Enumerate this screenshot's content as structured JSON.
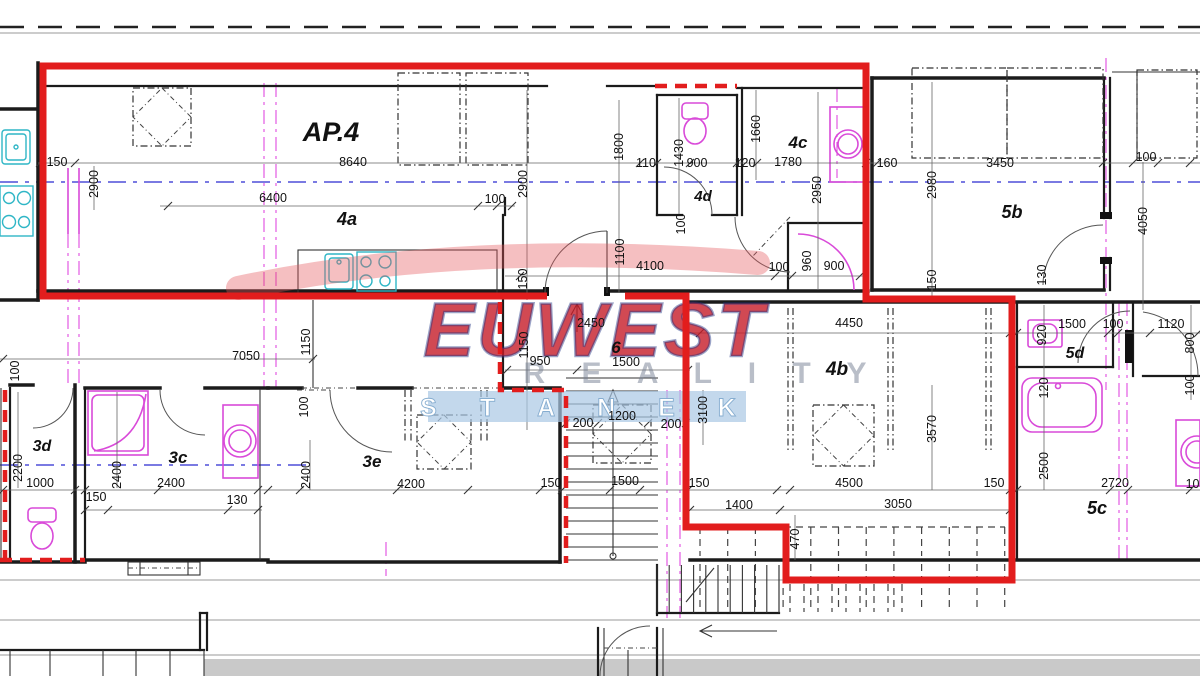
{
  "watermark": {
    "line1": "EUWEST",
    "line2": "R E A L I T Y",
    "line3": "S T A N E K"
  },
  "plan": {
    "apartment_label": "AP.4",
    "room_labels": [
      {
        "t": "AP.4",
        "x": 331,
        "y": 141,
        "s": 27
      },
      {
        "t": "4a",
        "x": 347,
        "y": 225,
        "s": 18
      },
      {
        "t": "4c",
        "x": 798,
        "y": 148,
        "s": 17
      },
      {
        "t": "4d",
        "x": 703,
        "y": 201,
        "s": 15
      },
      {
        "t": "5b",
        "x": 1012,
        "y": 218,
        "s": 18
      },
      {
        "t": "6",
        "x": 616,
        "y": 353,
        "s": 17
      },
      {
        "t": "4b",
        "x": 837,
        "y": 375,
        "s": 19
      },
      {
        "t": "5d",
        "x": 1075,
        "y": 358,
        "s": 16
      },
      {
        "t": "5c",
        "x": 1097,
        "y": 514,
        "s": 18
      },
      {
        "t": "3d",
        "x": 42,
        "y": 451,
        "s": 16
      },
      {
        "t": "3c",
        "x": 178,
        "y": 463,
        "s": 17
      },
      {
        "t": "3e",
        "x": 372,
        "y": 467,
        "s": 17
      }
    ],
    "dim_labels": [
      {
        "t": "150",
        "x": 57,
        "y": 166
      },
      {
        "t": "8640",
        "x": 353,
        "y": 166
      },
      {
        "t": "110",
        "x": 646,
        "y": 167
      },
      {
        "t": "900",
        "x": 697,
        "y": 167
      },
      {
        "t": "120",
        "x": 745,
        "y": 167
      },
      {
        "t": "1780",
        "x": 788,
        "y": 166
      },
      {
        "t": "160",
        "x": 887,
        "y": 167
      },
      {
        "t": "3450",
        "x": 1000,
        "y": 167
      },
      {
        "t": "100",
        "x": 1146,
        "y": 161
      },
      {
        "t": "2900",
        "x": 98,
        "y": 184,
        "r": 1
      },
      {
        "t": "2900",
        "x": 527,
        "y": 184,
        "r": 1
      },
      {
        "t": "1800",
        "x": 623,
        "y": 147,
        "r": 1
      },
      {
        "t": "1430",
        "x": 683,
        "y": 153,
        "r": 1
      },
      {
        "t": "1660",
        "x": 760,
        "y": 129,
        "r": 1
      },
      {
        "t": "2950",
        "x": 821,
        "y": 190,
        "r": 1
      },
      {
        "t": "2980",
        "x": 936,
        "y": 185,
        "r": 1
      },
      {
        "t": "4050",
        "x": 1147,
        "y": 221,
        "r": 1
      },
      {
        "t": "1100",
        "x": 624,
        "y": 252,
        "r": 1
      },
      {
        "t": "100",
        "x": 685,
        "y": 224,
        "r": 1
      },
      {
        "t": "150",
        "x": 527,
        "y": 279,
        "r": 1
      },
      {
        "t": "150",
        "x": 936,
        "y": 280,
        "r": 1
      },
      {
        "t": "130",
        "x": 1046,
        "y": 275,
        "r": 1
      },
      {
        "t": "960",
        "x": 811,
        "y": 261,
        "r": 1
      },
      {
        "t": "6400",
        "x": 273,
        "y": 202
      },
      {
        "t": "100",
        "x": 495,
        "y": 203
      },
      {
        "t": "4100",
        "x": 650,
        "y": 270
      },
      {
        "t": "100",
        "x": 779,
        "y": 271
      },
      {
        "t": "900",
        "x": 834,
        "y": 270
      },
      {
        "t": "7050",
        "x": 246,
        "y": 360
      },
      {
        "t": "1150",
        "x": 310,
        "y": 342,
        "r": 1
      },
      {
        "t": "1150",
        "x": 528,
        "y": 345,
        "r": 1
      },
      {
        "t": "950",
        "x": 540,
        "y": 365
      },
      {
        "t": "2450",
        "x": 591,
        "y": 327
      },
      {
        "t": "1500",
        "x": 626,
        "y": 366
      },
      {
        "t": "4450",
        "x": 849,
        "y": 327
      },
      {
        "t": "1500",
        "x": 1072,
        "y": 328
      },
      {
        "t": "100",
        "x": 1113,
        "y": 328
      },
      {
        "t": "1120",
        "x": 1171,
        "y": 328
      },
      {
        "t": "920",
        "x": 1046,
        "y": 335,
        "r": 1
      },
      {
        "t": "800",
        "x": 1194,
        "y": 343,
        "r": 1
      },
      {
        "t": "100",
        "x": 1194,
        "y": 385,
        "r": 1
      },
      {
        "t": "120",
        "x": 1048,
        "y": 388,
        "r": 1
      },
      {
        "t": "3100",
        "x": 707,
        "y": 410,
        "r": 1
      },
      {
        "t": "200",
        "x": 583,
        "y": 427
      },
      {
        "t": "1200",
        "x": 622,
        "y": 420
      },
      {
        "t": "200",
        "x": 671,
        "y": 428
      },
      {
        "t": "3570",
        "x": 936,
        "y": 429,
        "r": 1
      },
      {
        "t": "2500",
        "x": 1048,
        "y": 466,
        "r": 1
      },
      {
        "t": "2200",
        "x": 22,
        "y": 468,
        "r": 1
      },
      {
        "t": "2400",
        "x": 121,
        "y": 475,
        "r": 1
      },
      {
        "t": "100",
        "x": 308,
        "y": 407,
        "r": 1
      },
      {
        "t": "2400",
        "x": 310,
        "y": 475,
        "r": 1
      },
      {
        "t": "100",
        "x": 19,
        "y": 371,
        "r": 1
      },
      {
        "t": "1000",
        "x": 40,
        "y": 487
      },
      {
        "t": "2400",
        "x": 171,
        "y": 487
      },
      {
        "t": "150",
        "x": 96,
        "y": 501
      },
      {
        "t": "130",
        "x": 237,
        "y": 504
      },
      {
        "t": "4200",
        "x": 411,
        "y": 488
      },
      {
        "t": "150",
        "x": 551,
        "y": 487
      },
      {
        "t": "1500",
        "x": 625,
        "y": 485
      },
      {
        "t": "150",
        "x": 699,
        "y": 487
      },
      {
        "t": "4500",
        "x": 849,
        "y": 487
      },
      {
        "t": "150",
        "x": 994,
        "y": 487
      },
      {
        "t": "2720",
        "x": 1115,
        "y": 487
      },
      {
        "t": "100",
        "x": 1196,
        "y": 488
      },
      {
        "t": "3050",
        "x": 898,
        "y": 508
      },
      {
        "t": "1400",
        "x": 739,
        "y": 509
      },
      {
        "t": "470",
        "x": 799,
        "y": 539,
        "r": 1
      }
    ]
  }
}
